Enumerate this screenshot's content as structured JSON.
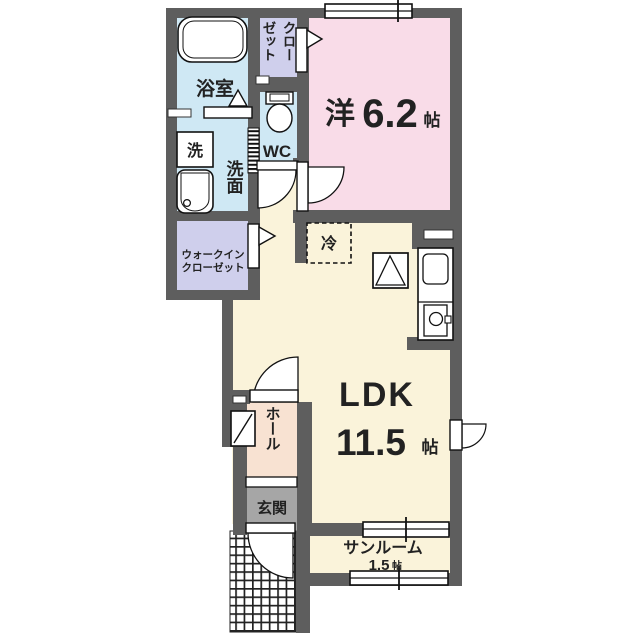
{
  "colors": {
    "wall": "#5e5e5e",
    "water": "#cfe8f4",
    "closet": "#cfcfec",
    "bedroom": "#f9dce8",
    "floor": "#faf3da",
    "hall": "#f8e2d2",
    "genkan": "#a6a6a6",
    "line": "#1a1a1a"
  },
  "rooms": {
    "bathroom": {
      "label": "浴室"
    },
    "washer": {
      "label": "洗"
    },
    "washroom": {
      "label": "洗面"
    },
    "closet": {
      "label": "クローゼット",
      "column_right": "クロー",
      "column_left": "ゼット"
    },
    "wc": {
      "label": "WC"
    },
    "bedroom": {
      "prefix": "洋",
      "size": "6.2",
      "unit": "帖"
    },
    "walk_in_closet": {
      "line1": "ウォークイン",
      "line2": "クローゼット"
    },
    "refrigerator": {
      "label": "冷"
    },
    "ldk": {
      "label": "LDK",
      "size": "11.5",
      "unit": "帖"
    },
    "hall": {
      "label": "ホール"
    },
    "entrance": {
      "label": "玄関"
    },
    "sunroom": {
      "label": "サンルーム",
      "size": "1.5",
      "unit": "帖"
    }
  }
}
